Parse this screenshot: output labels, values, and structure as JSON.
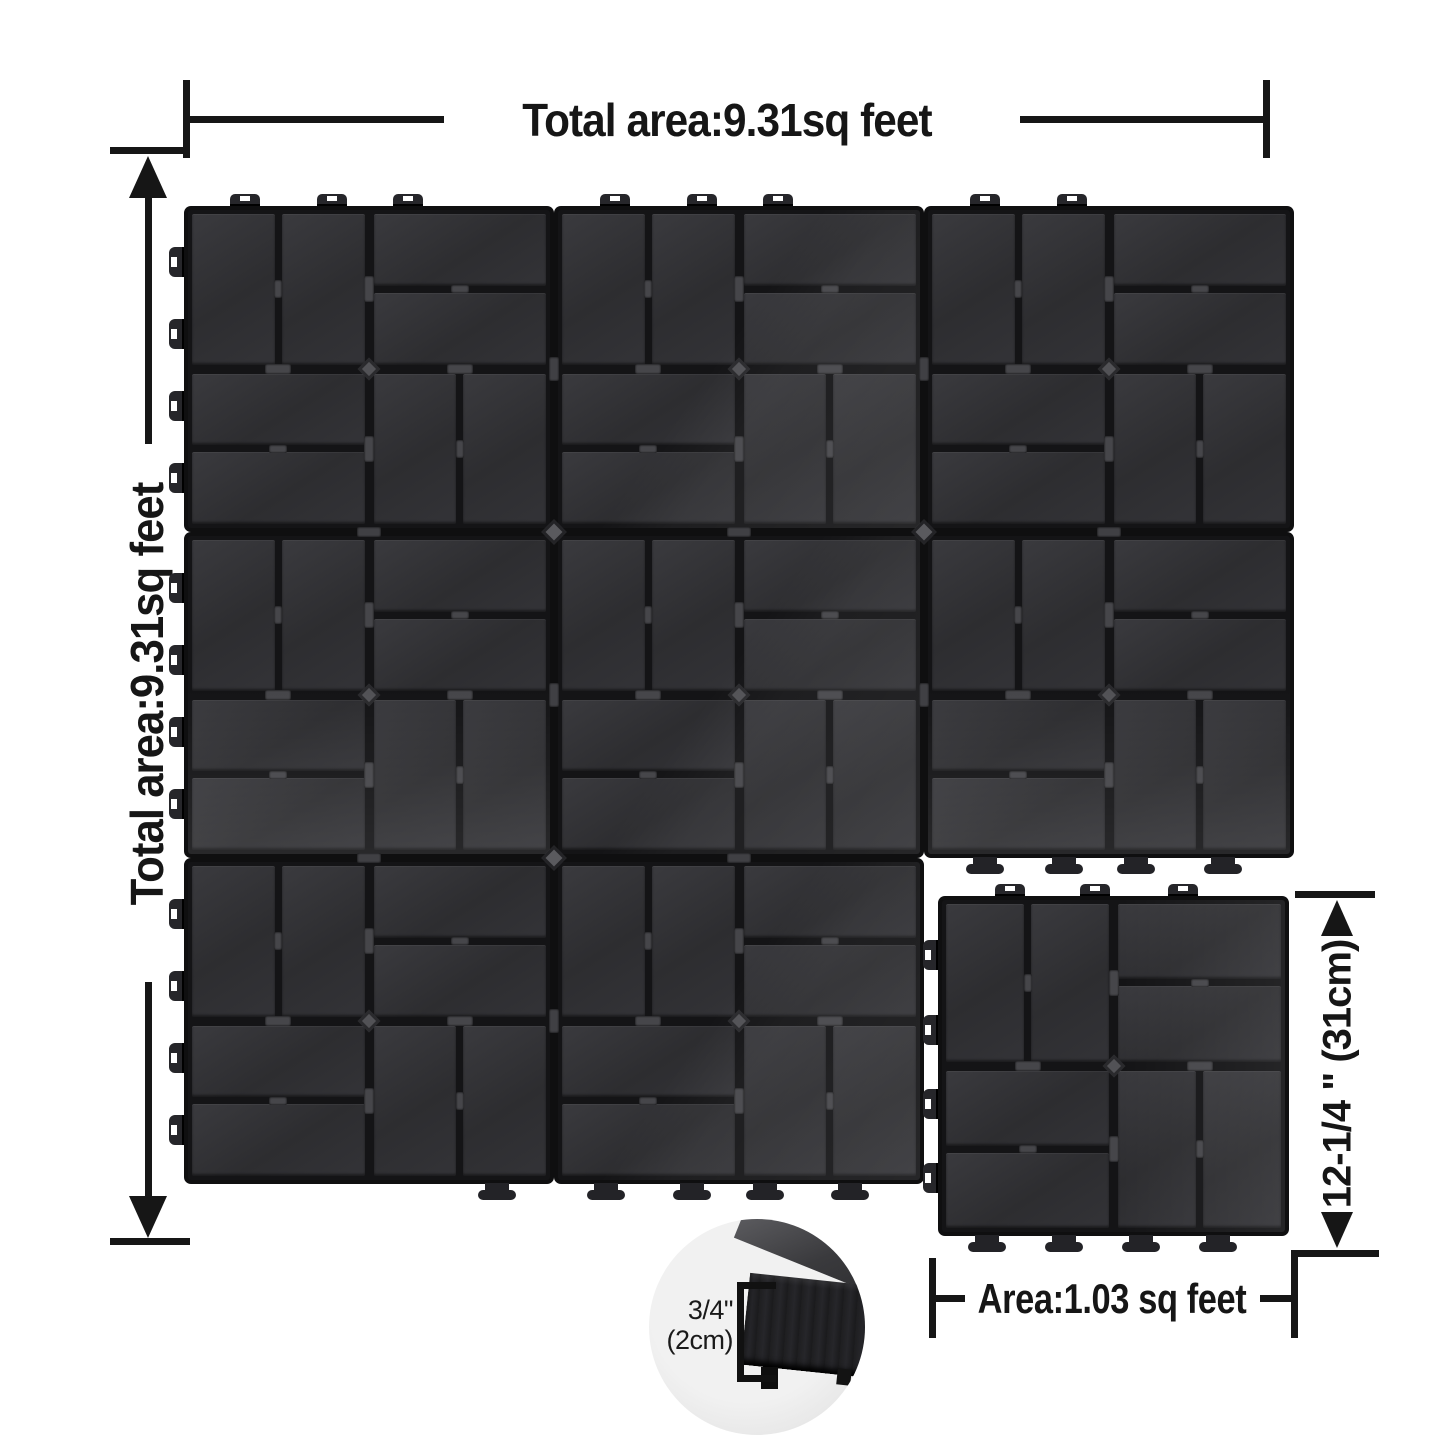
{
  "title": "Interlocking deck tile dimension diagram",
  "labels": {
    "total_width": "Total area:9.31sq feet",
    "total_height": "Total area:9.31sq feet",
    "tile_height": "12-1/4 \" (31cm)",
    "tile_area": "Area:1.03 sq feet",
    "thickness_inch": "3/4\"",
    "thickness_cm": "(2cm)"
  },
  "diagram": {
    "background_color": "#ffffff",
    "line_color": "#161616",
    "tile_colors": {
      "slat": "#313134",
      "slat_highlight": "#3a3a3e",
      "base_gap": "#141416",
      "edge": "#0f0f10",
      "connector": "#4a4a4e"
    },
    "main_group": {
      "tile_count": 8,
      "origin": {
        "x": 188,
        "y": 210
      },
      "tile_size": {
        "w": 362,
        "h": 318
      },
      "seam": 8,
      "cells": [
        {
          "col": 0,
          "row": 0,
          "sheen": "none",
          "top_tabs": [
            57,
            144,
            220
          ],
          "left_tabs": [
            52,
            124,
            196,
            268
          ],
          "feet": []
        },
        {
          "col": 1,
          "row": 0,
          "sheen": "diag",
          "top_tabs": [
            57,
            144,
            220
          ],
          "left_tabs": [],
          "feet": []
        },
        {
          "col": 2,
          "row": 0,
          "sheen": "none",
          "top_tabs": [
            57,
            144
          ],
          "left_tabs": [],
          "feet": []
        },
        {
          "col": 0,
          "row": 1,
          "sheen": "bottom",
          "top_tabs": [],
          "left_tabs": [
            52,
            124,
            196,
            268
          ],
          "feet": []
        },
        {
          "col": 1,
          "row": 1,
          "sheen": "diag",
          "top_tabs": [],
          "left_tabs": [],
          "feet": []
        },
        {
          "col": 2,
          "row": 1,
          "sheen": "bottom",
          "top_tabs": [],
          "left_tabs": [],
          "feet": [
            57,
            136,
            208,
            295
          ]
        },
        {
          "col": 0,
          "row": 2,
          "sheen": "none",
          "top_tabs": [],
          "left_tabs": [
            52,
            124,
            196,
            268
          ],
          "feet": [
            309
          ]
        },
        {
          "col": 1,
          "row": 2,
          "sheen": "diag",
          "top_tabs": [],
          "left_tabs": [],
          "feet": [
            48,
            134,
            207,
            292
          ]
        }
      ]
    },
    "single_tile": {
      "x": 942,
      "y": 900,
      "w": 343,
      "h": 332,
      "sheen": "right",
      "top_tabs": [
        68,
        153,
        241
      ],
      "left_tabs": [
        55,
        130,
        204,
        278
      ],
      "feet": [
        45,
        122,
        199,
        276
      ]
    },
    "junctions": [
      [
        554,
        532
      ],
      [
        924,
        532
      ],
      [
        554,
        858
      ]
    ],
    "seam_clips": [
      {
        "x": 554,
        "y": 369,
        "v": true
      },
      {
        "x": 554,
        "y": 695,
        "v": true
      },
      {
        "x": 554,
        "y": 1021,
        "v": true
      },
      {
        "x": 924,
        "y": 369,
        "v": true
      },
      {
        "x": 924,
        "y": 695,
        "v": true
      },
      {
        "x": 369,
        "y": 532,
        "v": false
      },
      {
        "x": 739,
        "y": 532,
        "v": false
      },
      {
        "x": 1109,
        "y": 532,
        "v": false
      },
      {
        "x": 369,
        "y": 858,
        "v": false
      },
      {
        "x": 739,
        "y": 858,
        "v": false
      }
    ]
  }
}
